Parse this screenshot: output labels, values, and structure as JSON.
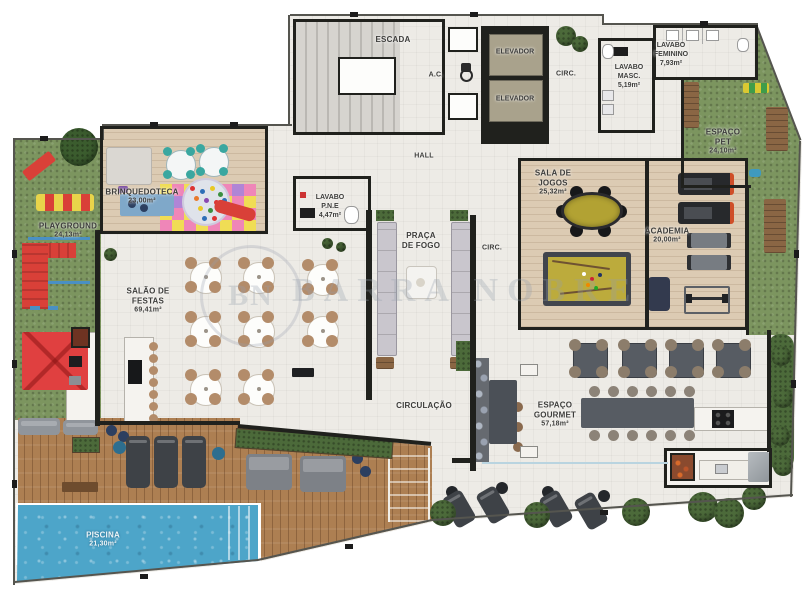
{
  "plan": {
    "watermark": {
      "monogram": "BN",
      "text": "BARRA NOBRE"
    },
    "rooms": {
      "escada": {
        "label": "ESCADA"
      },
      "ac": {
        "label": "A.C."
      },
      "elevador_1": {
        "label": "ELEVADOR"
      },
      "elevador_2": {
        "label": "ELEVADOR"
      },
      "circ_top": {
        "label": "CIRC."
      },
      "hall": {
        "label": "HALL"
      },
      "lavabo_masc": {
        "label": "LAVABO\nMASC.",
        "area": "5,19m²"
      },
      "lavabo_feminino": {
        "label": "LAVABO\nFEMININO",
        "area": "7,93m²"
      },
      "espaco_pet": {
        "label": "ESPAÇO\nPET",
        "area": "24,10m²"
      },
      "playground": {
        "label": "PLAYGROUND",
        "area": "24,13m²"
      },
      "brinquedoteca": {
        "label": "BRINQUEDOTECA",
        "area": "23,00m²"
      },
      "lavabo_pne": {
        "label": "LAVABO\nP.N.E",
        "area": "4,47m²"
      },
      "praca_de_fogo": {
        "label": "PRAÇA\nDE FOGO"
      },
      "circ_mid": {
        "label": "CIRC."
      },
      "sala_de_jogos": {
        "label": "SALA DE\nJOGOS",
        "area": "25,32m²"
      },
      "academia": {
        "label": "ACADEMIA",
        "area": "20,00m²"
      },
      "salao_de_festas": {
        "label": "SALÃO DE\nFESTAS",
        "area": "69,41m²"
      },
      "circulacao": {
        "label": "CIRCULAÇÃO"
      },
      "espaco_gourmet": {
        "label": "ESPAÇO\nGOURMET",
        "area": "57,18m²"
      },
      "piscina": {
        "label": "PISCINA",
        "area": "21,30m²"
      }
    }
  }
}
